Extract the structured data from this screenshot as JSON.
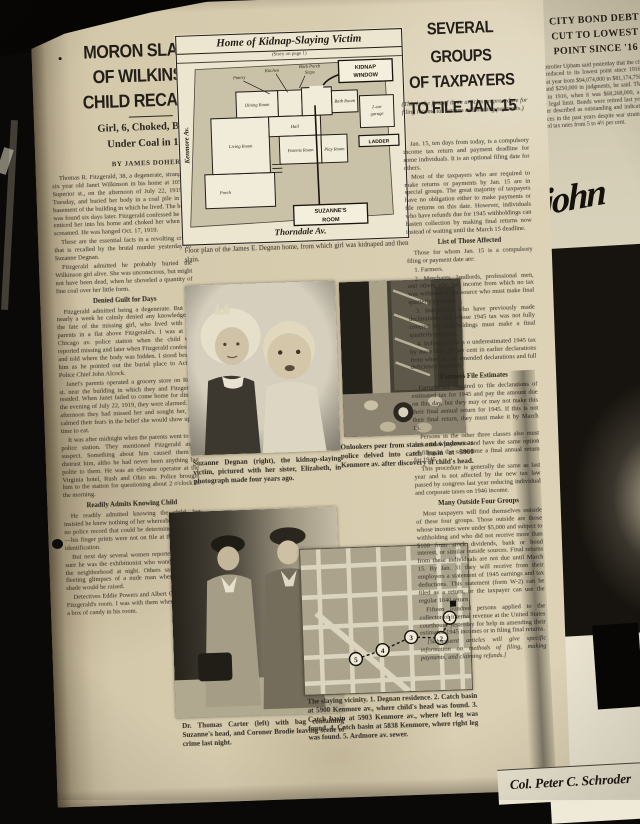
{
  "theme": {
    "paper": "#d5c9ac",
    "paper_light": "#efead8",
    "ink": "#2c2823",
    "photo_dark": "#2f2b24"
  },
  "left_article": {
    "bullet": "•",
    "headline_lines": [
      "MORON SLAYING",
      "OF WILKINSON",
      "CHILD RECALLED"
    ],
    "deck_lines": [
      "Girl, 6, Choked, Buried",
      "Under Coal in 1919"
    ],
    "byline": "BY JAMES DOHERTY",
    "body": [
      {
        "style": "p",
        "text": "Thomas R. Fitzgerald, 38, a degenerate, strangled six year old Janet Wilkinson in his home at 105 E. Superior st., on the afternoon of July 22, 1919, a Tuesday, and buried her body in a coal pile in the basement of the building in which he lived. The body was found six days later. Fitzgerald confessed he had enticed her into his home and choked her when she screamed. He was hanged Oct. 17, 1919."
      },
      {
        "style": "p",
        "text": "These are the essential facts in a revolting crime that is recalled by the brutal murder yesterday of Suzanne Degnan."
      },
      {
        "style": "p",
        "text": "Fitzgerald admitted he probably buried the Wilkinson girl alive. She was unconscious, but might not have been dead, when he shoveled a quantity of fine coal over her little form."
      },
      {
        "style": "sub",
        "text": "Denied Guilt for Days"
      },
      {
        "style": "p",
        "text": "Fitzgerald admitted being a degenerate. But for nearly a week he calmly denied any knowledge of the fate of the missing girl, who lived with her parents in a flat above Fitzgerald's. I was at the Chicago av. police station when the child was reported missing and later when Fitzgerald confessed and told where the body was hidden. I stood beside him as he pointed out the burial place to Acting Police Chief John Alcock."
      },
      {
        "style": "p",
        "text": "Janet's parents operated a grocery store on Rush st. near the building in which they and Fitzgerald resided. When Janet failed to come home for dinner the evening of July 22, 1919, they were alarmed. All afternoon they had missed her and sought her, but calmed their fears in the belief she would show up in time to eat."
      },
      {
        "style": "p",
        "text": "It was after midnight when the parents went to the police station. They mentioned Fitzgerald as a suspect. Something about him caused them to distrust him, altho he had never been anything but polite to them. He was an elevator operator at the Virginia hotel, Rush and Ohio sts. Police brought him to the station for questioning about 2 o'clock in the morning."
      },
      {
        "style": "sub",
        "text": "Readily Admits Knowing Child"
      },
      {
        "style": "p",
        "text": "He readily admitted knowing the child, but insisted he knew nothing of her whereabouts. He had no police record that could be determined that night—his finger prints were not on file at the bureau of identification."
      },
      {
        "style": "p",
        "text": "But next day several women reported they were sure he was the exhibitionist who wandered around the neighborhood at night. Others said they had fleeting glimpses of a nude man when a window shade would be raised."
      },
      {
        "style": "p",
        "text": "Detectives Eddie Powers and Albert Otis searched Fitzgerald's room. I was with them when they found a box of candy in his room."
      }
    ]
  },
  "floorplan": {
    "title": "Home of Kidnap-Slaying Victim",
    "note": "(Story on page 1)",
    "streets": {
      "left": "Kenmore Av.",
      "bottom": "Thorndale Av."
    },
    "rooms": {
      "porch": "Porch",
      "living": "Living Room",
      "dining": "Dining Room",
      "hall": "Hall",
      "kitchen": "Kitchen",
      "pantry": "Pantry",
      "parents": "Parents Room",
      "play": "Play Room",
      "bath": "Bath Room",
      "steps_1": "Back Porch",
      "steps_2": "Steps"
    },
    "callouts": {
      "kidnap_1": "KIDNAP",
      "kidnap_2": "WINDOW",
      "suzanne_1": "SUZANNE'S",
      "suzanne_2": "ROOM",
      "ladder": "LADDER",
      "garage_1": "2-car",
      "garage_2": "garage"
    },
    "caption": "Floor plan of the James E. Degnan home, from which girl was kidnaped and then slain."
  },
  "photos": {
    "children_caption": "Suzanne Degnan (right), the kidnap-slaying victim, pictured with her sister, Elizabeth, in photograph made four years ago.",
    "onlookers_caption": "Onlookers peer from stairs and windows as police delved into catch basin at 5900 Kenmore av. after discovery of child's head.",
    "carter_caption": "Dr. Thomas Carter (left) with bag containing Suzanne's head, and Coroner Brodie leaving scene of crime last night."
  },
  "map": {
    "markers": [
      "1",
      "2",
      "3",
      "4",
      "5"
    ],
    "caption": "The slaying vicinity. 1. Degnan residence. 2. Catch basin at 5900 Kenmore av., where child's head was found. 3. Catch basin at 5903 Kenmore av., where left leg was found. 4. Catch basin at 5838 Kenmore, where right leg was found. 5. Ardmore av. sewer."
  },
  "right_article": {
    "headline_lines": [
      "SEVERAL GROUPS",
      "OF TAXPAYERS",
      "TO FILE JAN. 15"
    ],
    "intro": "(This is the first of three articles on procedure for filing income tax returns and making payments.)",
    "body": [
      {
        "style": "p",
        "text": "Jan. 15, ten days from today, is a compulsory income tax return and payment deadline for some individuals. It is an optional filing date for others."
      },
      {
        "style": "p",
        "text": "Most of the taxpayers who are required to make returns or payments by Jan. 15 are in special groups. The great majority of taxpayers have no obligation either to make payments or file returns on this date. However, individuals who have refunds due for 1945 withholdings can hasten collection by making final returns now instead of waiting until the March 15 deadline."
      },
      {
        "style": "sub",
        "text": "List of Those Affected"
      },
      {
        "style": "p",
        "text": "Those for whom Jan. 15 is a compulsory filing or payment date are:"
      },
      {
        "style": "p",
        "text": "1. Farmers."
      },
      {
        "style": "p",
        "text": "2. Merchants, landlords, professional men, and others who had income from which no tax was withheld at the source who must make final quarterly payment."
      },
      {
        "style": "p",
        "text": "3. Individuals who have previously made declarations and whose 1945 tax was not fully covered by withholdings must make a final quarterly payment."
      },
      {
        "style": "p",
        "text": "4. Individuals w h o underestimated 1945 tax by more than 20 per cent in earlier declarations from whom is due amended declarations and full deficiency payment."
      },
      {
        "style": "sub",
        "text": "Farmers File Estimates"
      },
      {
        "style": "p",
        "text": "Farmers are required to file declarations of estimated tax for 1945 and pay the amount due on this day, but they may or may not make this their final annual return for 1945. If this is not their final return, they must make it by March 15."
      },
      {
        "style": "p",
        "text": "Persons in the other three classes also must make final payments and have the same option of filing at the same time a final annual return for 1945."
      },
      {
        "style": "p",
        "text": "This procedure is generally the same as last year and is not affected by the new tax law passed by congress last year reducing individual and corporate taxes on 1946 income."
      },
      {
        "style": "sub",
        "text": "Many Outside Four Groups"
      },
      {
        "style": "p",
        "text": "Most taxpayers will find themselves outside of these four groups. Those outside are those whose incomes were under $5,000 and subject to withholding and who did not receive more than $100 from stock dividends, bank or bond interest, or similar outside sources. Final returns from these individuals are not due until March 15. By Jan. 31 they will receive from their employers a statement of 1945 earnings and tax deductions. This statement (form W-2) can be filed as a return, or the taxpayer can use the regular 1040 return."
      },
      {
        "style": "p",
        "text": "Fifteen hundred persons applied to the collector of internal revenue at the United States courthouse yesterday for help in amending their estimated 1945 incomes or in filing final returns."
      },
      {
        "style": "p",
        "text": "[Subsequent articles will give specific information on methods of filing, making payments, and claiming refunds.]"
      }
    ]
  },
  "adjacent_page": {
    "headline_lines": [
      "CITY BOND DEBT",
      "CUT TO LOWEST",
      "POINT SINCE '16"
    ],
    "body": "City Comptroller Upham said yesterday that the city's bonded debt has been reduced to its lowest point since 1916. The debt was reduced last year from $94,074,000 to $81,174,750, with payments in bonds and $250,000 in judgments, he said. The lowest bonded debt was in 1916, when it was $68,268,000, a margin of 20% below the legal limit. Bonds were retired last year in volume the comptroller described as outstanding and indicating the health of city finances in the past years despite war strains, he said, noting the reduced tax rates from 5 to 4½ per cent.",
    "ad_signature": "john",
    "ad_name": "Col. Peter C. Schroder"
  }
}
